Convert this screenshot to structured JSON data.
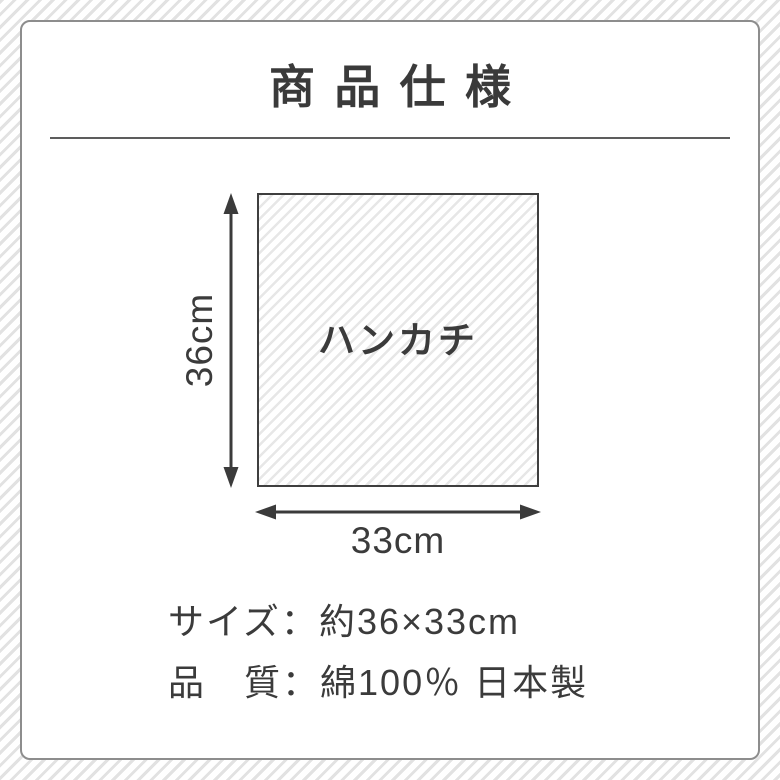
{
  "header": {
    "title": "商品仕様"
  },
  "diagram": {
    "item_label": "ハンカチ",
    "height_label": "36cm",
    "width_label": "33cm"
  },
  "specs": {
    "rows": [
      {
        "label": "サイズ",
        "separator": "：",
        "value": "約36×33cm"
      },
      {
        "label": "品　質",
        "separator": "：",
        "value": "綿100％ 日本製"
      }
    ]
  },
  "colors": {
    "ink": "#3b3b3b",
    "title": "#3a3a3a",
    "divider": "#5d5d5d",
    "panel_border": "#8d8d8d",
    "pattern_stripe": "#e2e2e2",
    "square_stripe": "#e7e7e7",
    "square_border": "#3f3f3f",
    "background": "#ffffff"
  }
}
